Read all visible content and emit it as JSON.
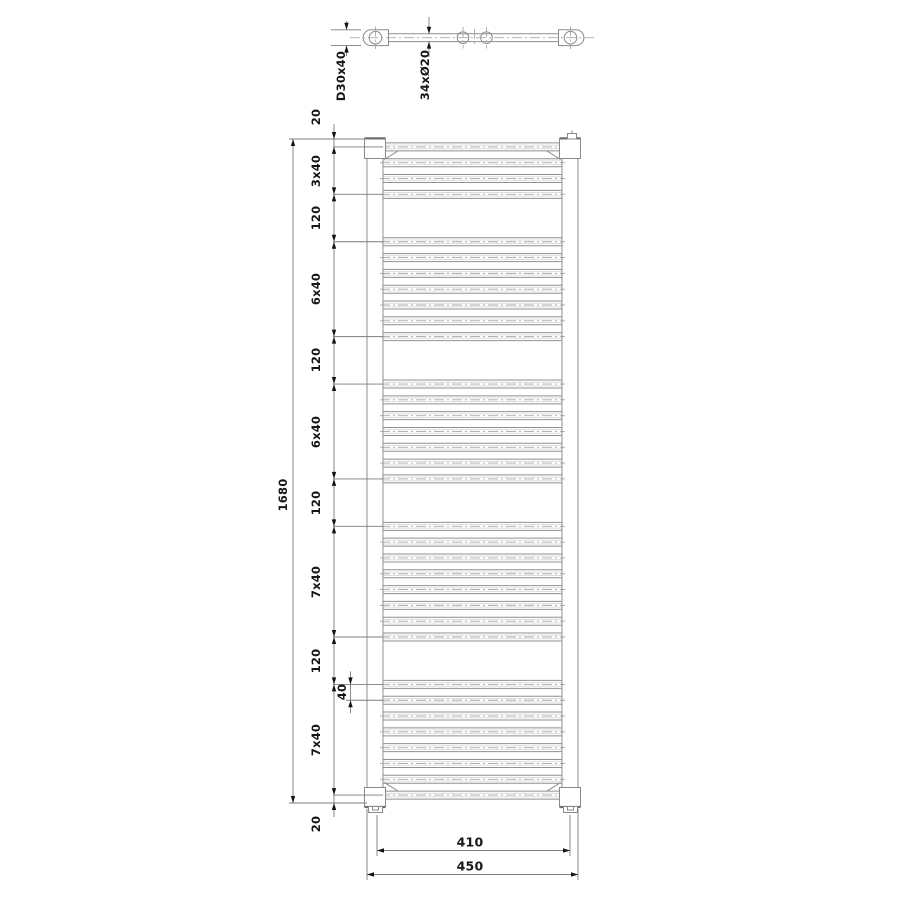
{
  "colors": {
    "background": "#ffffff",
    "outline": "#8f8f8f",
    "light_line": "#dcdcdc",
    "centerline": "#a8a8a8",
    "dimension_line": "#7d7d7d",
    "text": "#161616"
  },
  "top_view": {
    "profile_label": "D30x40",
    "rungs_label": "34xØ20"
  },
  "front_view": {
    "overall_height": "1680",
    "overall_width": "450",
    "center_width": "410",
    "rung_spacing_detail": "40",
    "chain": [
      {
        "label": "20",
        "mm": 20
      },
      {
        "label": "3x40",
        "mm": 120
      },
      {
        "label": "120",
        "mm": 120
      },
      {
        "label": "6x40",
        "mm": 240
      },
      {
        "label": "120",
        "mm": 120
      },
      {
        "label": "6x40",
        "mm": 240
      },
      {
        "label": "120",
        "mm": 120
      },
      {
        "label": "7x40",
        "mm": 280
      },
      {
        "label": "120",
        "mm": 120
      },
      {
        "label": "7x40",
        "mm": 280
      },
      {
        "label": "20",
        "mm": 20
      }
    ],
    "rung_groups": [
      {
        "start_mm": 20,
        "count": 4,
        "spacing_mm": 40
      },
      {
        "start_mm": 260,
        "count": 7,
        "spacing_mm": 40
      },
      {
        "start_mm": 620,
        "count": 7,
        "spacing_mm": 40
      },
      {
        "start_mm": 980,
        "count": 8,
        "spacing_mm": 40
      },
      {
        "start_mm": 1380,
        "count": 8,
        "spacing_mm": 40
      }
    ],
    "rung_count": 34,
    "rung_diameter_mm": 20,
    "total_height_mm": 1680
  }
}
